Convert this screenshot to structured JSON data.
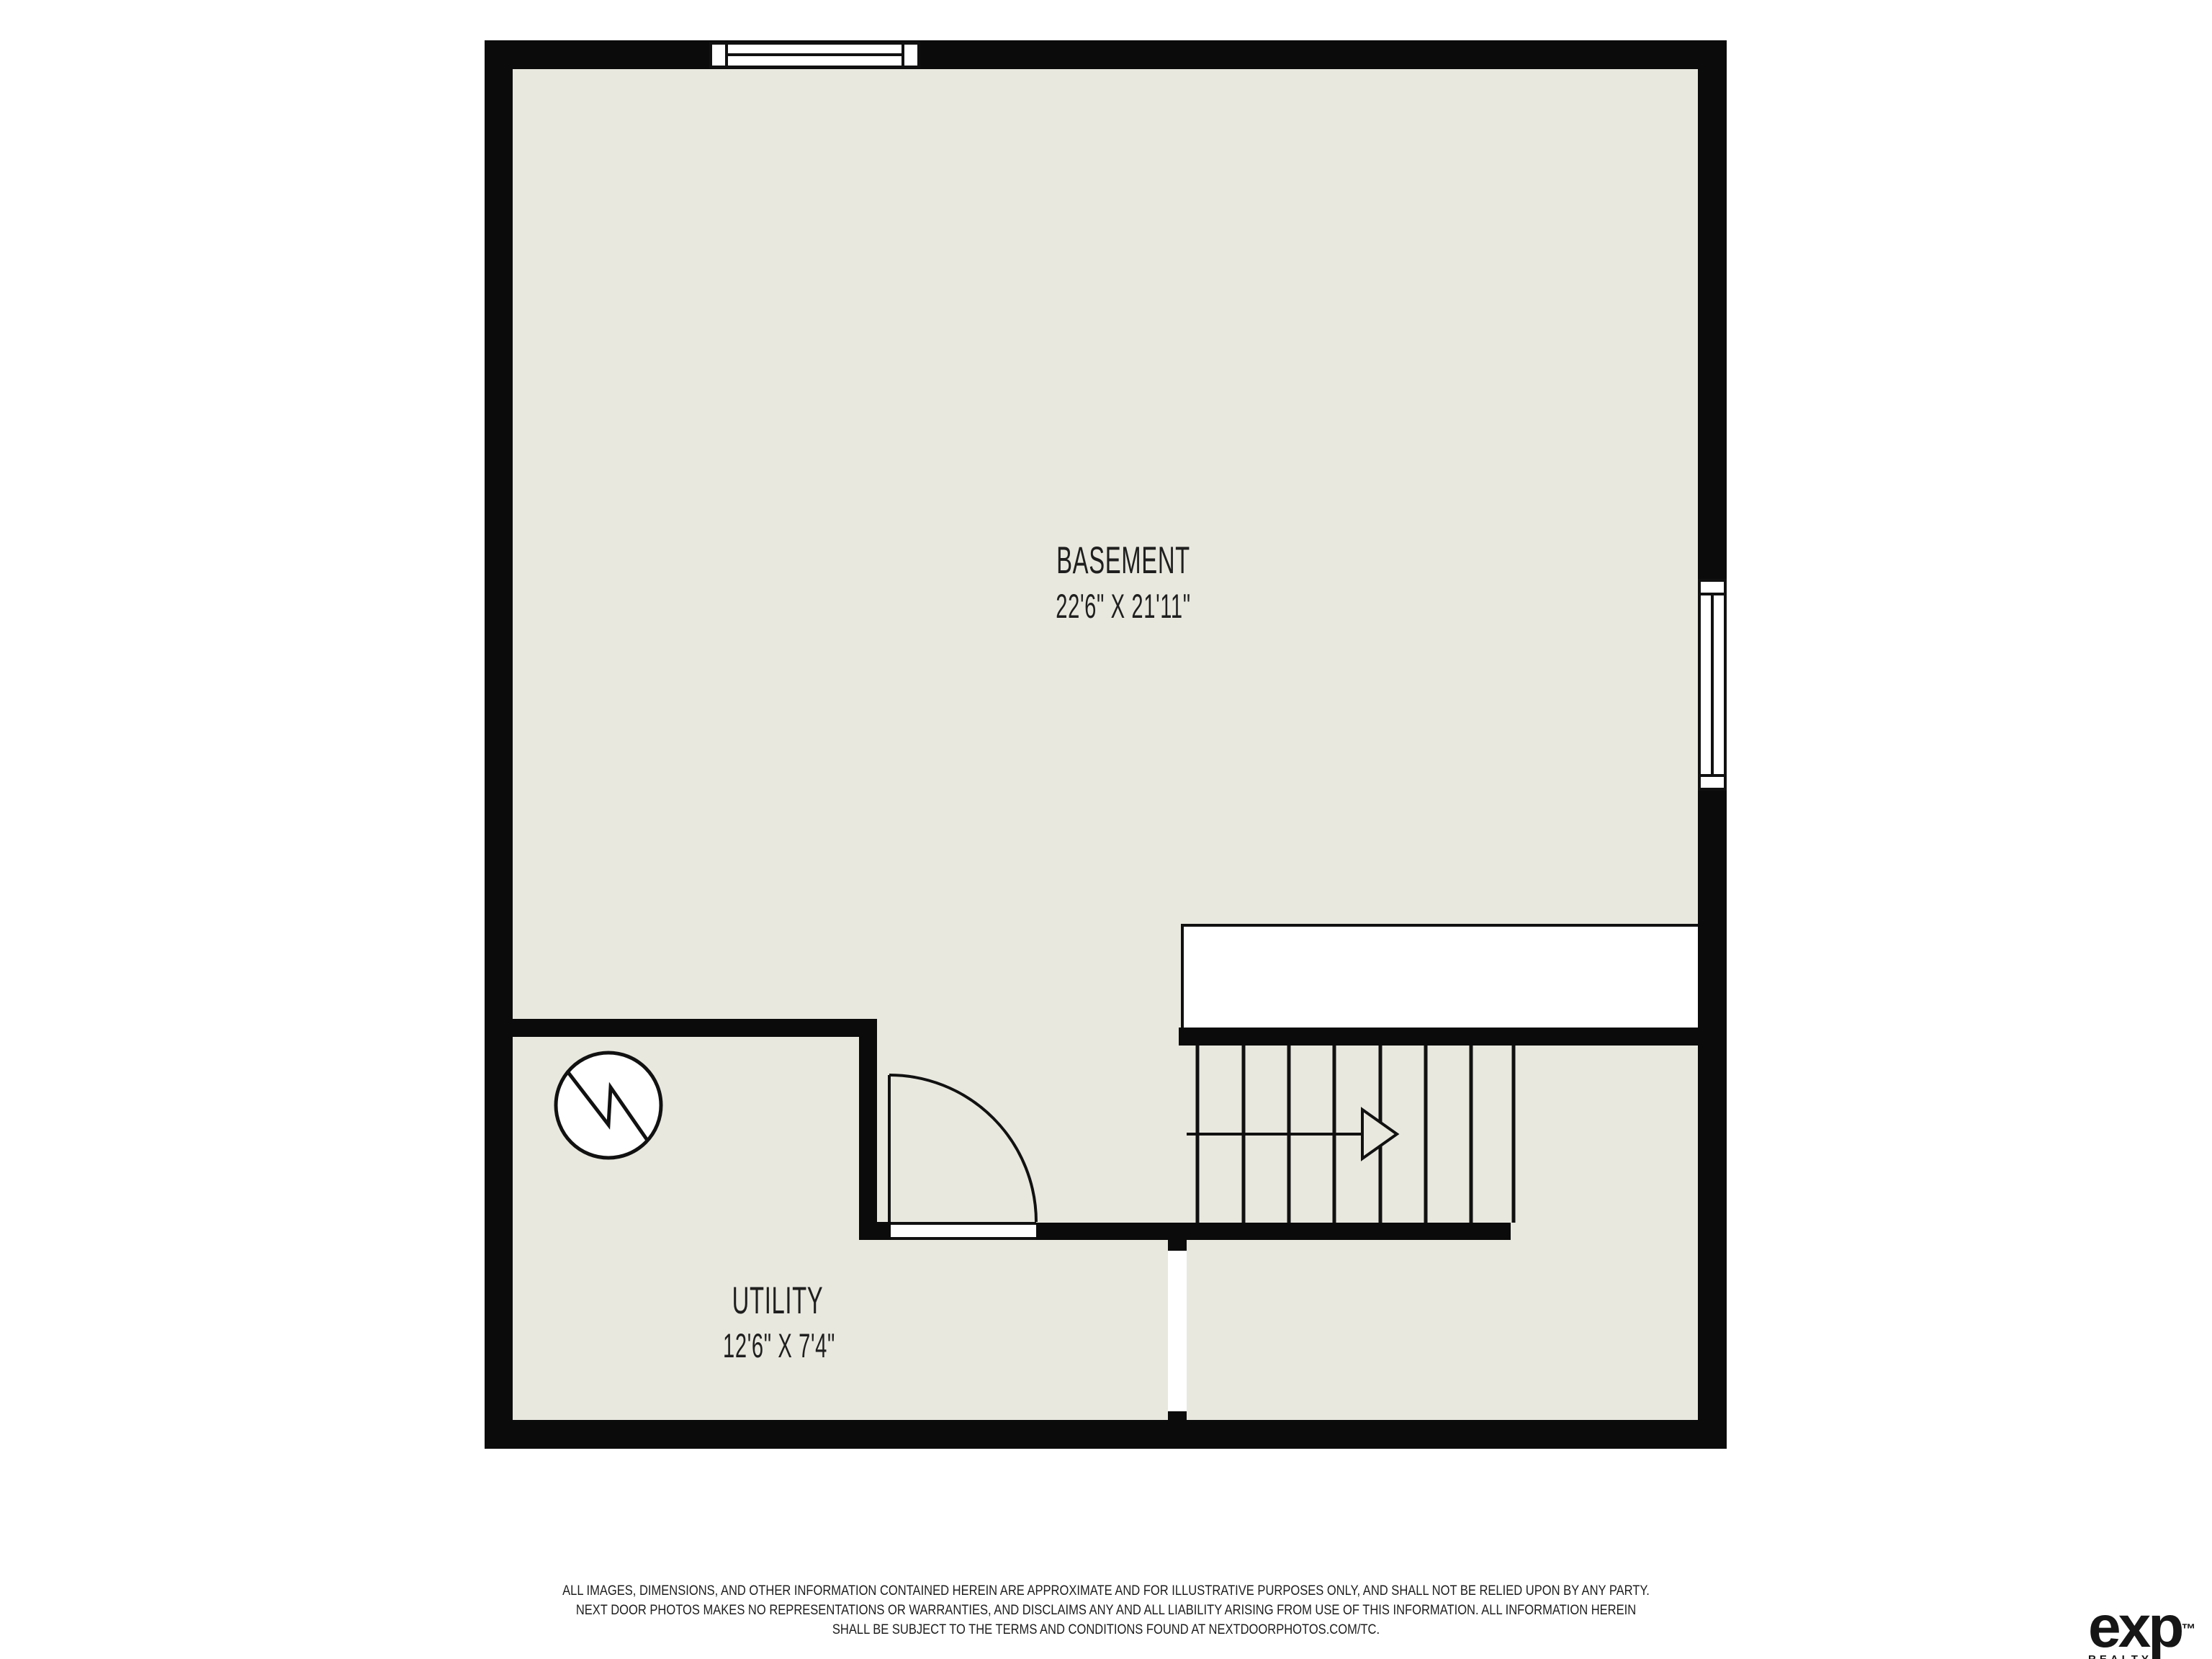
{
  "colors": {
    "background": "#ffffff",
    "wall": "#0b0b0b",
    "floor": "#e9e8df",
    "text": "#1f1f1f"
  },
  "rooms": [
    {
      "name": "BASEMENT",
      "dimensions": "22'6\" X 21'11\""
    },
    {
      "name": "UTILITY",
      "dimensions": "12'6\" X 7'4\""
    }
  ],
  "stairs": {
    "direction": "right"
  },
  "footer": {
    "disclaimer_lines": [
      "ALL IMAGES, DIMENSIONS, AND OTHER INFORMATION CONTAINED HEREIN ARE APPROXIMATE AND FOR ILLUSTRATIVE PURPOSES ONLY, AND SHALL NOT BE RELIED UPON BY ANY PARTY.",
      "NEXT DOOR PHOTOS MAKES NO REPRESENTATIONS OR WARRANTIES, AND DISCLAIMS ANY AND ALL LIABILITY ARISING FROM USE OF THIS INFORMATION. ALL INFORMATION HEREIN",
      "SHALL BE SUBJECT TO THE TERMS AND CONDITIONS FOUND AT NEXTDOORPHOTOS.COM/TC."
    ],
    "brand": {
      "wordmark": "exp",
      "trademark": "™",
      "subtitle": "REALTY"
    }
  }
}
